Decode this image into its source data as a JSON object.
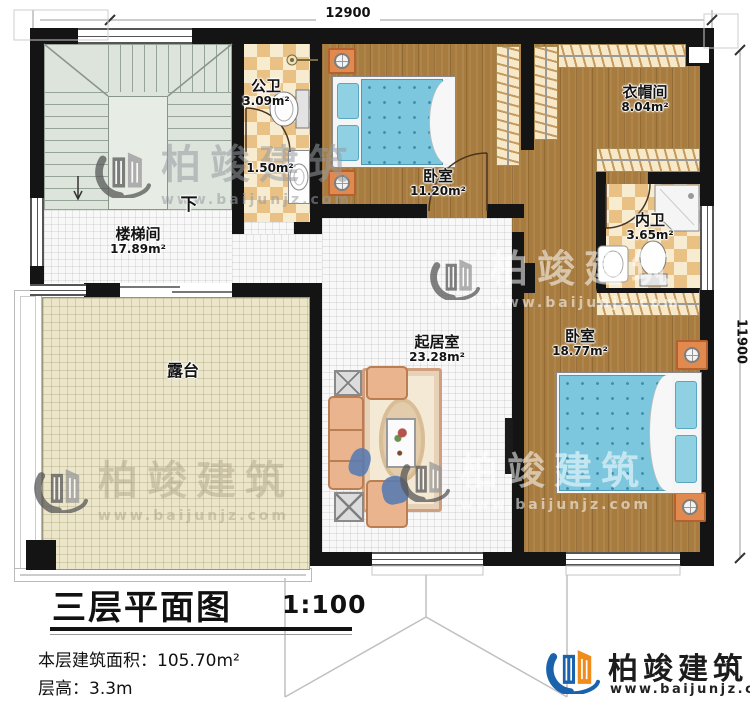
{
  "plan": {
    "dimension_top": "12900",
    "dimension_right": "11900",
    "stair_down_label": "下",
    "rooms": {
      "stairwell": {
        "name": "楼梯间",
        "area": "17.89m²"
      },
      "public_bath": {
        "name": "公卫",
        "area": "3.09m²"
      },
      "bath_lobby": {
        "area": "1.50m²"
      },
      "bedroom1": {
        "name": "卧室",
        "area": "11.20m²"
      },
      "cloakroom": {
        "name": "衣帽间",
        "area": "8.04m²"
      },
      "ensuite_bath": {
        "name": "内卫",
        "area": "3.65m²"
      },
      "bedroom2": {
        "name": "卧室",
        "area": "18.77m²"
      },
      "living_room": {
        "name": "起居室",
        "area": "23.28m²"
      },
      "terrace": {
        "name": "露台"
      }
    }
  },
  "title_block": {
    "title": "三层平面图",
    "scale": "1:100",
    "floor_area_label": "本层建筑面积：",
    "floor_area_value": "105.70m²",
    "floor_height_label": "层高：",
    "floor_height_value": "3.3m"
  },
  "branding": {
    "company": "柏竣建筑",
    "website": "www.baijunjz.com"
  },
  "colors": {
    "wall": "#141414",
    "wood_floor": "#a87c3e",
    "checker_dark": "#eac184",
    "checker_light": "#f8ecd0",
    "terrace": "#ebe5ca",
    "bed_blue": "#7cc7dd",
    "brand_blue": "#1b62ad",
    "brand_orange": "#ef8c1c"
  }
}
